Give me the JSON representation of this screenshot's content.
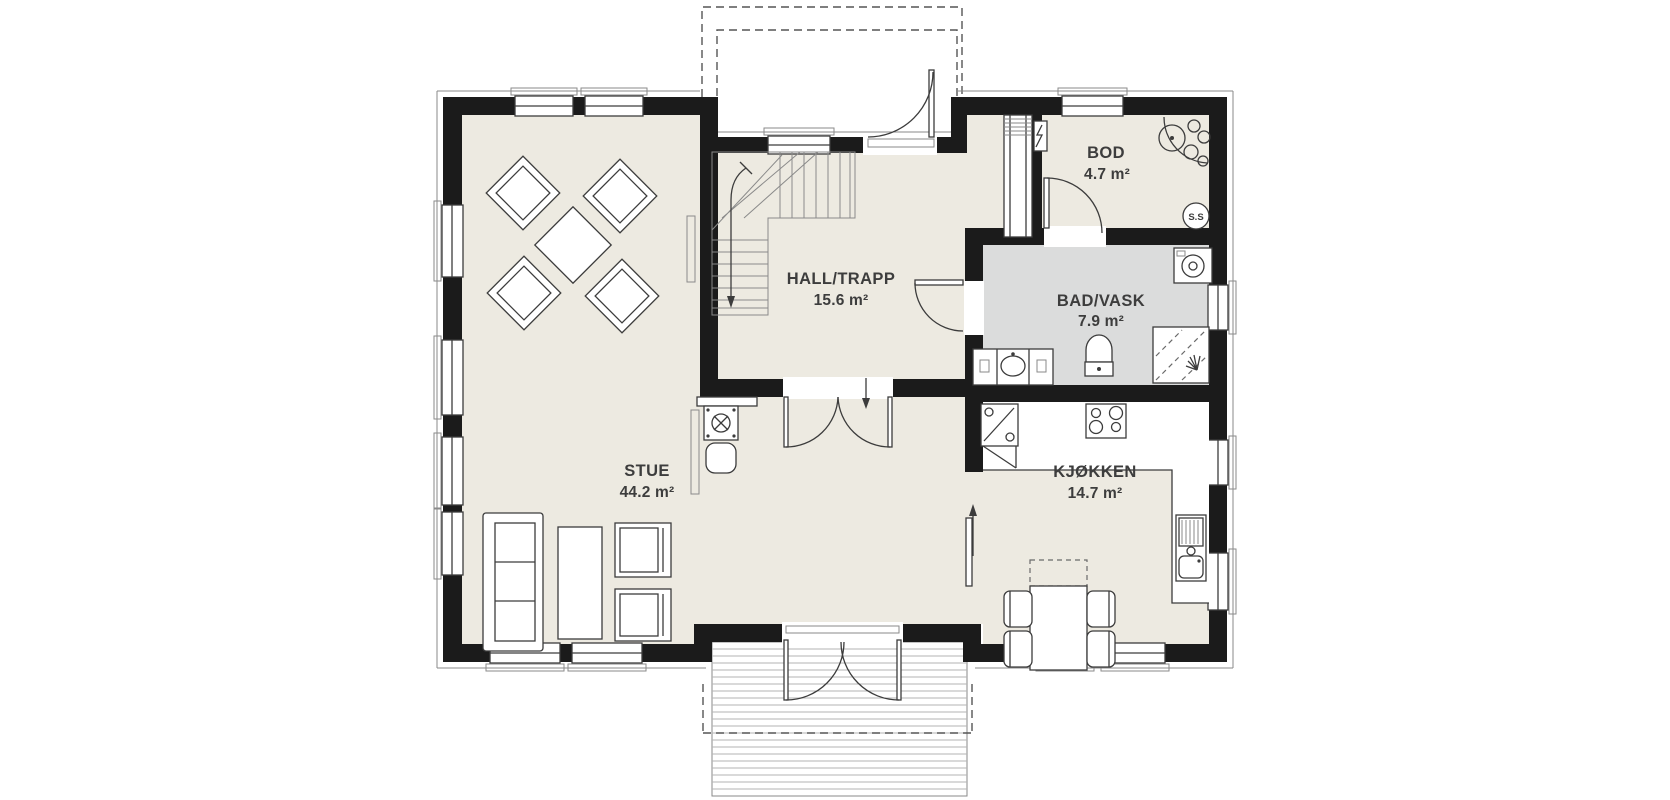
{
  "plan": {
    "rooms": [
      {
        "name": "STUE",
        "area": "44.2 m²"
      },
      {
        "name": "HALL/TRAPP",
        "area": "15.6 m²"
      },
      {
        "name": "BOD",
        "area": "4.7 m²"
      },
      {
        "name": "BAD/VASK",
        "area": "7.9 m²"
      },
      {
        "name": "KJØKKEN",
        "area": "14.7 m²"
      }
    ],
    "labels": {
      "central_vacuum": "S.S"
    },
    "colors": {
      "wall": "#1b1b1b",
      "floor": "#edeae1",
      "wet_room_floor": "#dbdcdc",
      "line": "#3c3c3c",
      "background": "#ffffff"
    }
  }
}
